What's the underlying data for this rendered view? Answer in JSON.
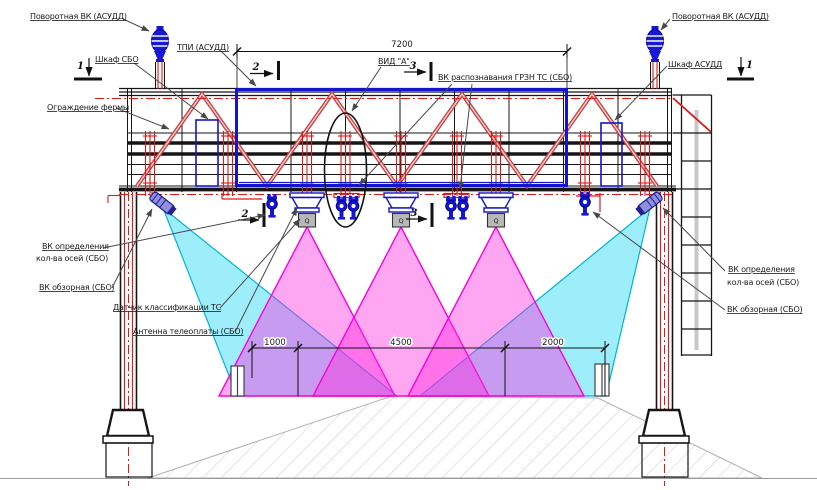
{
  "drawing": {
    "labels": {
      "pov_vk": "Поворотная ВК (АСУДД)",
      "tpi": "ТПИ (АСУДД)",
      "shkaf_sbo": "Шкаф СБО",
      "shkaf_asudd": "Шкаф АСУДД",
      "ograzhdenie": "Ограждение фермы",
      "vid_a": "ВИД \"А\"",
      "grzn": "ВК распознавания ГРЗН ТС (СБО)",
      "vk_opred_line1": "ВК определения",
      "vk_opred_line2": "кол-ва осей (СБО)",
      "vk_obzor": "ВК обзорная (СБО)",
      "datchik": "Датчик классификации ТС",
      "antenna": "Антенна телеоплаты (СБО)"
    },
    "dimensions": {
      "span": "7200",
      "left": "1000",
      "mid": "4500",
      "right": "2000"
    },
    "sections": {
      "s1": "1",
      "s2": "2",
      "s3": "3"
    },
    "device_box_glyph": "Q",
    "colors": {
      "structure_red": "#e01818",
      "equipment_blue": "#1414cc",
      "beam_magenta": "#ff2ce0",
      "beam_cyan": "#00d0f4"
    }
  }
}
